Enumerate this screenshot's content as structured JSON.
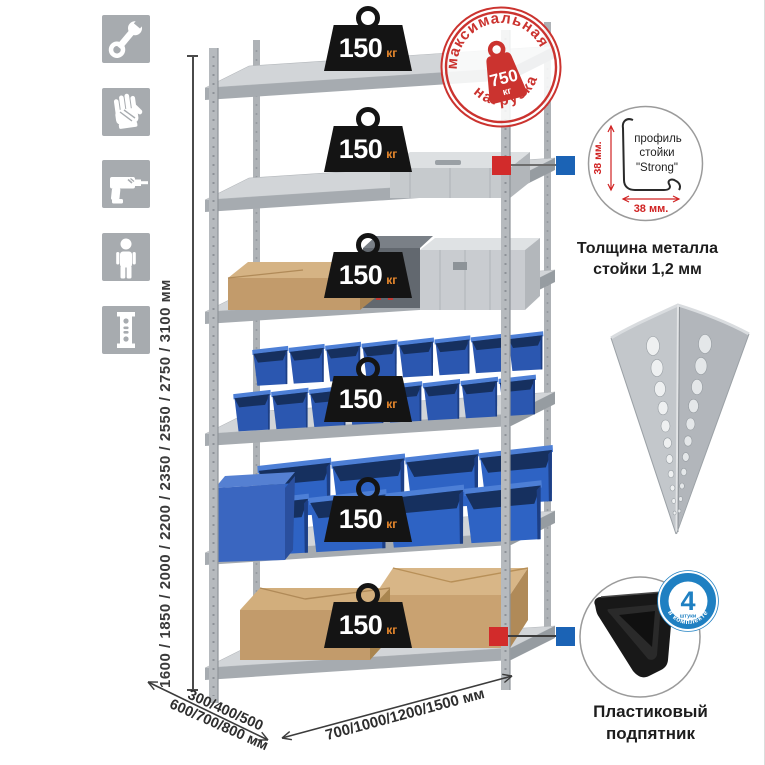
{
  "colors": {
    "stamp_red": "#cb332f",
    "marker_red": "#d22b2b",
    "marker_blue": "#1b63b5",
    "quantity_badge_blue": "#1f80c2",
    "bin_blue": "#2b57b0",
    "weight_badge_black": "#141414",
    "weight_unit_orange": "#e8882d",
    "icon_tile_gray": "#a7abaf"
  },
  "left_icons": {
    "items": [
      {
        "id": "wrench"
      },
      {
        "id": "gloves"
      },
      {
        "id": "drill"
      },
      {
        "id": "person"
      },
      {
        "id": "post-profile"
      }
    ]
  },
  "height_dimension": {
    "label": "1600 / 1850 / 2000 / 2200 / 2350 / 2550 / 2750 / 3100 мм"
  },
  "shelf_load": {
    "value": "150",
    "unit": "кг",
    "count": 6
  },
  "max_load_stamp": {
    "arc_top": "максимальная",
    "arc_bottom": "нагрузка",
    "value": "750",
    "unit": "кг"
  },
  "profile_detail": {
    "vertical_dim": "38 мм.",
    "horizontal_dim": "38 мм.",
    "caption_line1": "профиль",
    "caption_line2": "стойки",
    "caption_line3": "\"Strong\"",
    "description_line1": "Толщина металла",
    "description_line2": "стойки 1,2 мм"
  },
  "foot_detail": {
    "badge_value": "4",
    "badge_small": "штуки",
    "badge_arc": "в комплекте",
    "caption_line1": "Пластиковый",
    "caption_line2": "подпятник"
  },
  "depth_dimension": {
    "line1": "300/400/500",
    "line2": "600/700/800 мм"
  },
  "width_dimension": {
    "label": "700/1000/1200/1500 мм"
  }
}
